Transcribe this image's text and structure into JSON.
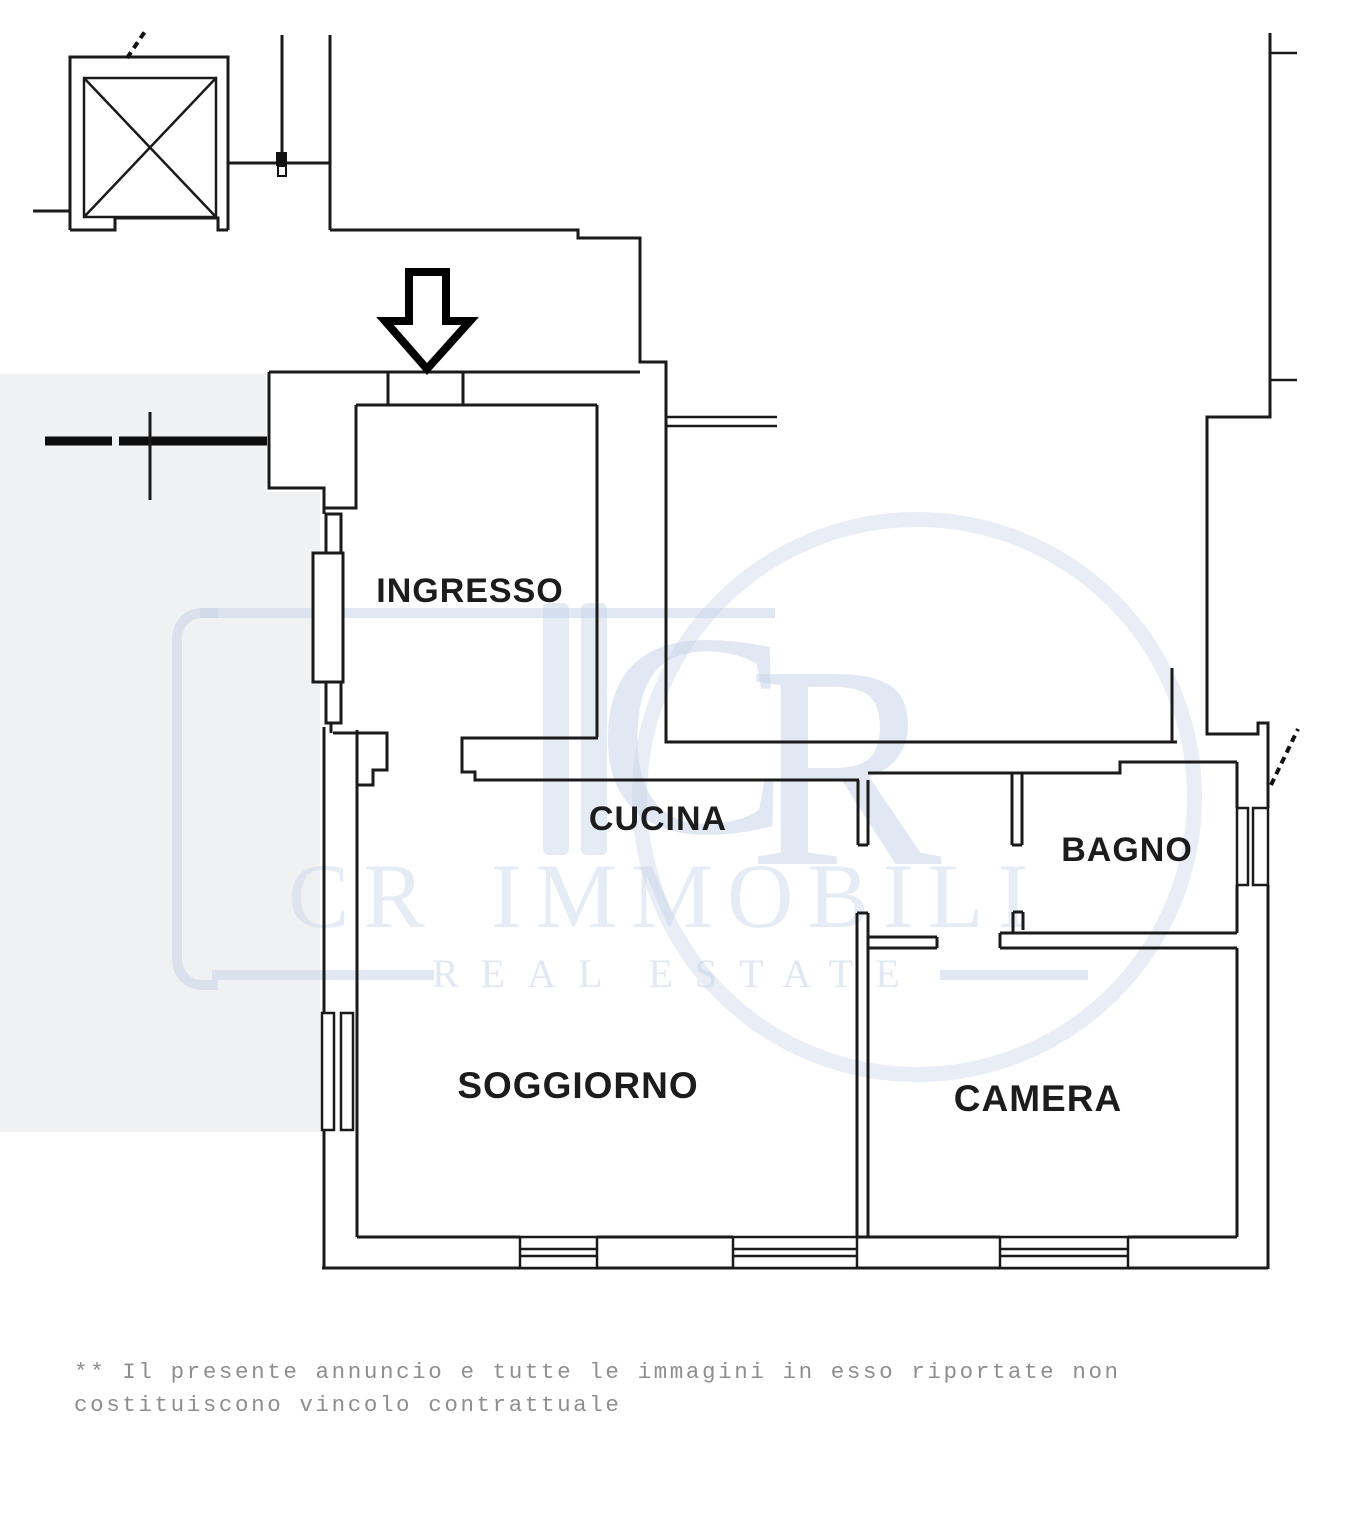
{
  "floor_plan": {
    "ink_color": "#1a1a1a",
    "rooms": [
      {
        "name": "ingresso",
        "label": "INGRESSO"
      },
      {
        "name": "cucina",
        "label": "CUCINA"
      },
      {
        "name": "bagno",
        "label": "BAGNO"
      },
      {
        "name": "soggiorno",
        "label": "SOGGIORNO"
      },
      {
        "name": "camera",
        "label": "CAMERA"
      }
    ]
  },
  "watermark": {
    "color": "#c6d2e8",
    "monogram_c": "C",
    "monogram_r": "R",
    "brand_initials": "CR",
    "brand_name": "IMMOBILI",
    "tagline_word1": "REAL",
    "tagline_word2": "ESTATE"
  },
  "disclaimer": {
    "color": "#8e8e8e",
    "line1": "** Il presente annuncio e tutte le immagini in esso riportate non",
    "line2": "costituiscono vincolo contrattuale"
  }
}
